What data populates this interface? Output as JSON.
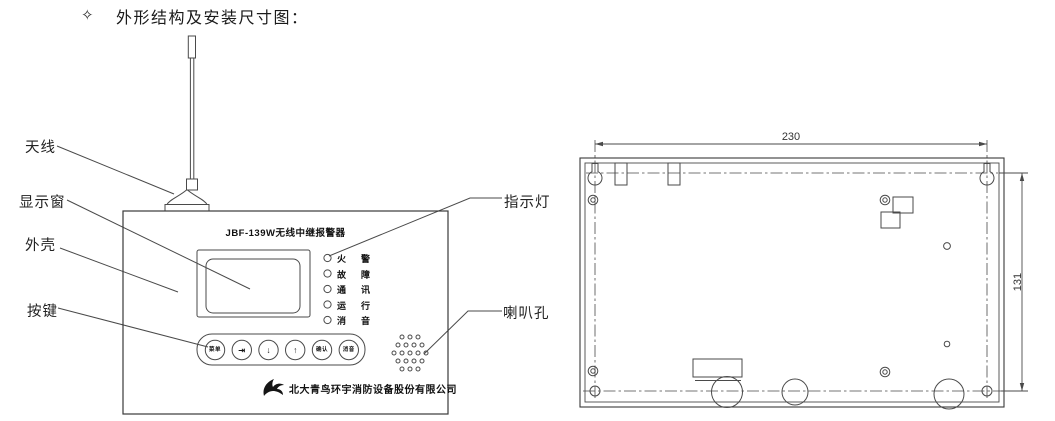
{
  "header": {
    "bullet": "✧",
    "title": "外形结构及安装尺寸图："
  },
  "front_view": {
    "labels": {
      "antenna": "天线",
      "display_window": "显示窗",
      "housing": "外壳",
      "keys": "按键",
      "indicator_light": "指示灯",
      "speaker_hole": "喇叭孔"
    },
    "panel": {
      "model_title": "JBF-139W无线中继报警器",
      "indicators": [
        {
          "label": "火警"
        },
        {
          "label": "故障"
        },
        {
          "label": "通讯"
        },
        {
          "label": "运行"
        },
        {
          "label": "消音"
        }
      ],
      "buttons": [
        {
          "label": "菜单"
        },
        {
          "label": "⇥"
        },
        {
          "label": "↓"
        },
        {
          "label": "↑"
        },
        {
          "label": "确认"
        },
        {
          "label": "消音"
        }
      ],
      "brand": "北大青鸟环宇消防设备股份有限公司"
    }
  },
  "rear_view": {
    "dim_width_mm": "230",
    "dim_height_mm": "131"
  },
  "colors": {
    "ink": "#1c1c1c",
    "line": "#4a4a4a"
  }
}
